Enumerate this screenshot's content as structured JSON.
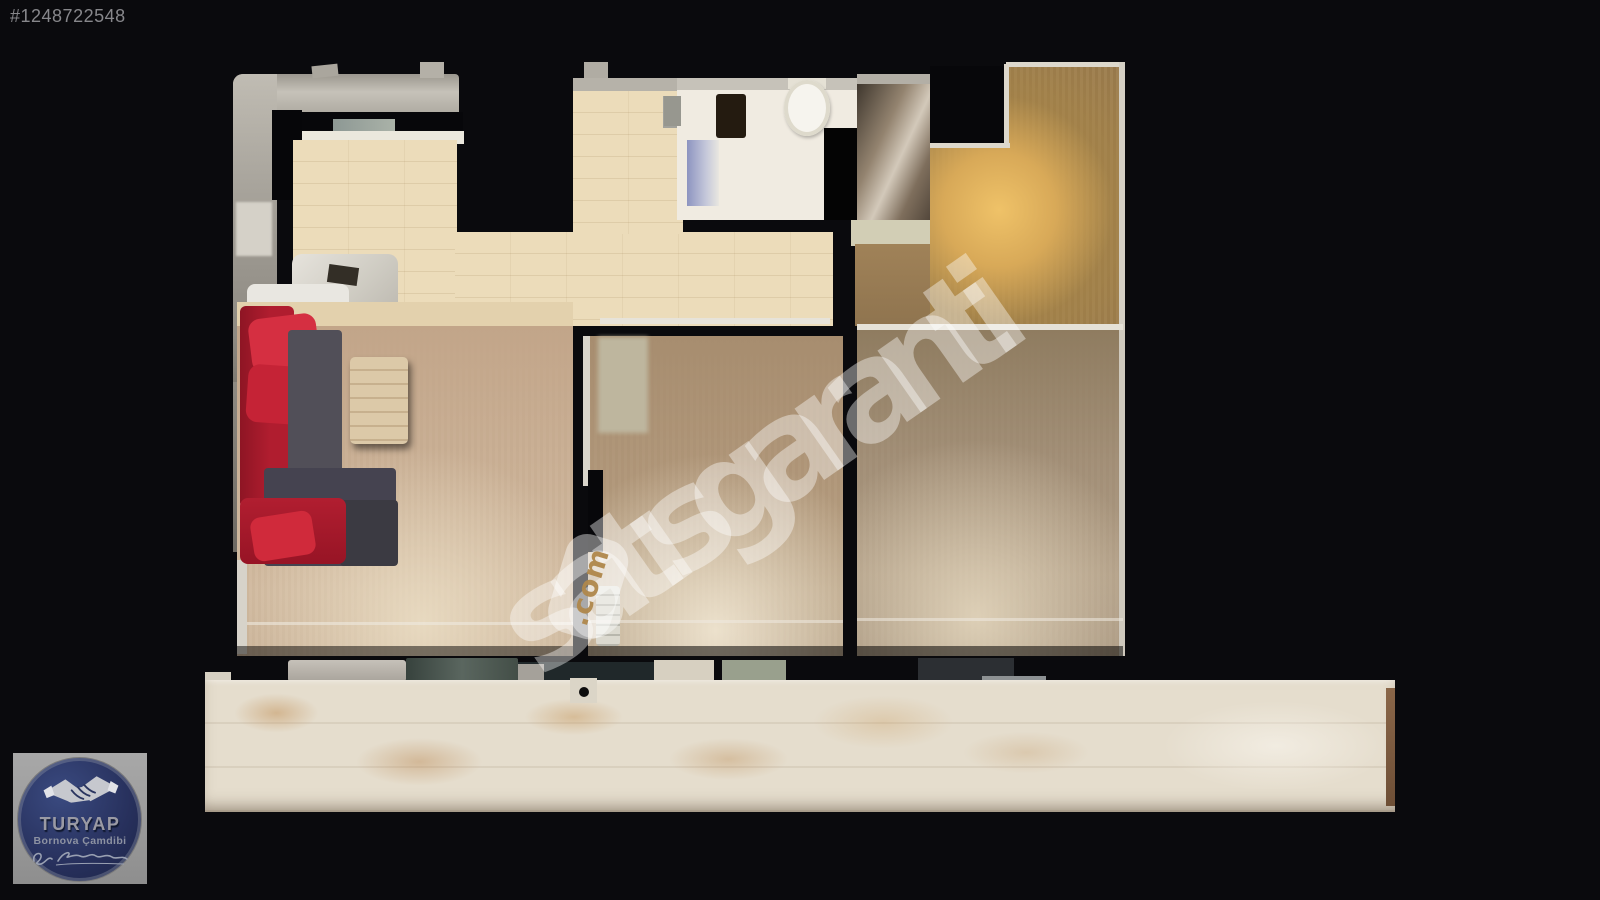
{
  "listing": {
    "id": "#1248722548"
  },
  "watermark": {
    "site_name": "satısgaranti",
    "site_tld": ".com"
  },
  "agency": {
    "brand": "TURYAP",
    "branch": "Bornova Çamdibi",
    "signature": "cursive signature (illegible)"
  },
  "floor_plan": {
    "type": "top-down 3D dollhouse scan of an apartment",
    "rooms": [
      {
        "name": "kitchen-entry",
        "floor": "beige tile",
        "color": "#ecdcba"
      },
      {
        "name": "bathroom",
        "floor": "white tile",
        "color": "#f0ebe1",
        "fixtures": [
          "toilet",
          "shower-glass",
          "dark-cabinet",
          "washing-machine"
        ]
      },
      {
        "name": "hallway",
        "floor": "beige tile",
        "color": "#e9dab6"
      },
      {
        "name": "living-room",
        "floor": "light wood",
        "color": "#c8ad92",
        "furniture": [
          "red-gray-corner-sofa",
          "wood-coffee-table"
        ]
      },
      {
        "name": "bedroom-1",
        "floor": "mid wood",
        "color": "#ab9173",
        "furniture": [
          "radiator"
        ]
      },
      {
        "name": "bedroom-2",
        "floor": "dark wood with warm light glow",
        "color": "#9b7c4e"
      },
      {
        "name": "balcony",
        "floor": "mottled white-tan stone",
        "color": "#e5ddcd"
      }
    ],
    "palette": {
      "background": "#0a0a0d",
      "sofa_red": "#c21f33",
      "sofa_gray": "#4a4852",
      "wall_gray": "#b3afa6",
      "logo_navy": "#27305c",
      "watermark_white": "rgba(255,255,255,0.40)"
    }
  }
}
